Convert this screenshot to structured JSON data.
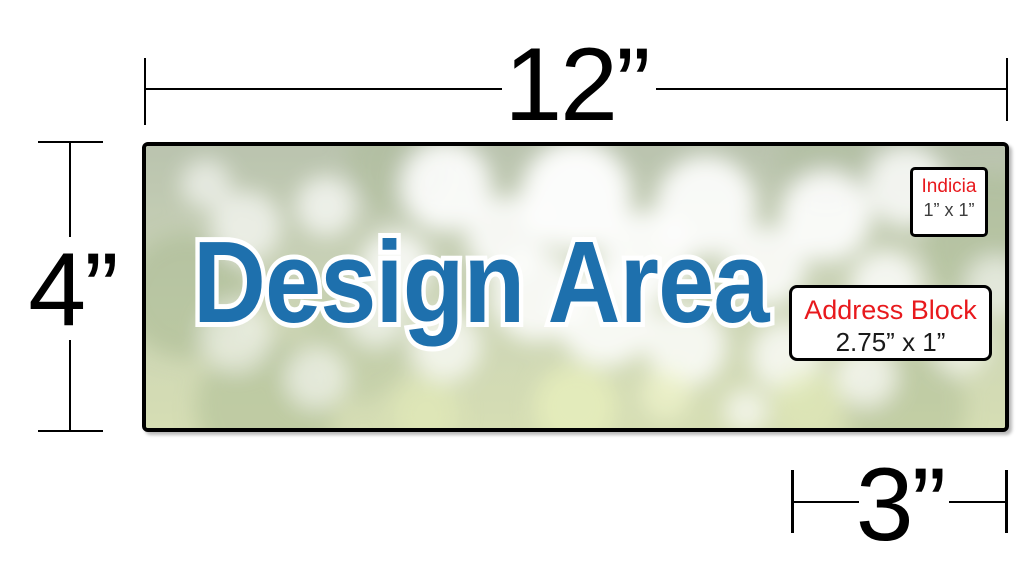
{
  "diagram": {
    "title": "Postcard template dimension diagram",
    "design_area_label": "Design Area",
    "dimensions": {
      "width_label": "12”",
      "height_label": "4”",
      "address_area_width_label": "3”"
    },
    "indicia": {
      "title": "Indicia",
      "size": "1” x 1”"
    },
    "address_block": {
      "title": "Address Block",
      "size": "2.75” x 1”"
    }
  },
  "colors": {
    "design_area_text": "#1e70ad",
    "label_red": "#e8191d",
    "dimension_lines": "#000000",
    "photo_green_light": "#ccd6a2",
    "photo_green_dark": "#8fa572"
  }
}
